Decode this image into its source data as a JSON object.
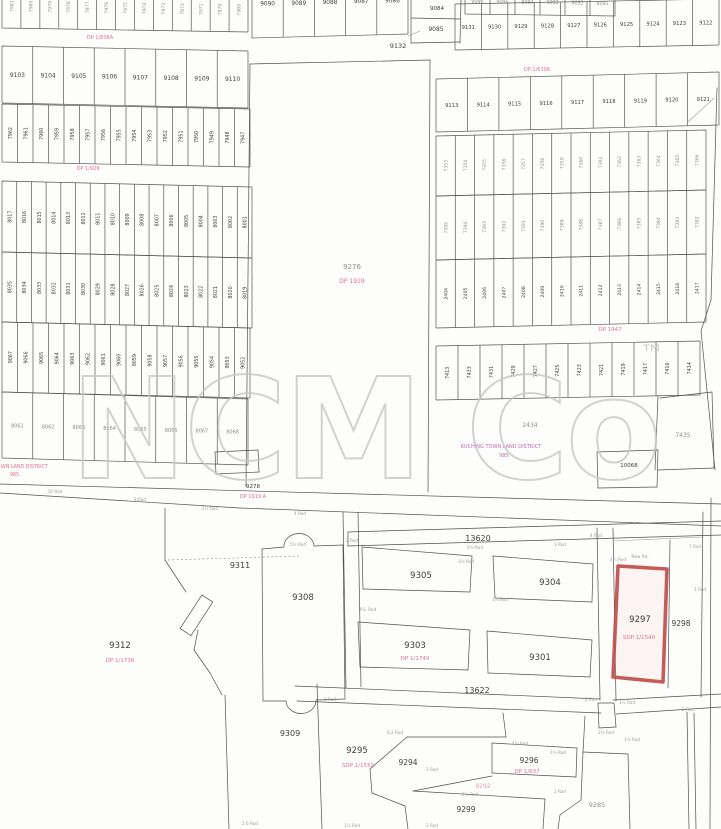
{
  "document": {
    "type": "scanned cadastral survey plan",
    "district_label": "KUCHING TOWN LAND DISTRICT",
    "district_number": "985"
  },
  "watermark": {
    "text": "NCM Co",
    "tm": "™",
    "color": "#c7c7c7"
  },
  "colors": {
    "ink": "#3d3d3d",
    "pink": "#e0718e",
    "magenta": "#bf6ab3",
    "red": "#c0504d",
    "faint": "#8d8d8d"
  },
  "red_parcel": {
    "lot": "9297",
    "plan": "SDP 1/1540",
    "points": "618,566 667,569 663,682 613,677",
    "label_x": 640,
    "label_y": 622,
    "sub_x": 639,
    "sub_y": 639,
    "color": "#c0504d"
  },
  "bands": [
    {
      "id": "top-left-cut-row",
      "x0": 2,
      "x1": 248,
      "yt": -16,
      "yb": 28,
      "sk": 4,
      "o": "v",
      "fs": 4.6,
      "faint": true,
      "labels": [
        "7981",
        "7980",
        "7979",
        "7978",
        "7977",
        "7976",
        "7975",
        "7974",
        "7973",
        "7972",
        "7971",
        "7970",
        "7969"
      ]
    },
    {
      "id": "row-9103",
      "x0": 2,
      "x1": 248,
      "yt": 46,
      "yb": 103,
      "sk": 5,
      "o": "h",
      "fs": 6,
      "labels": [
        "9103",
        "9104",
        "9105",
        "9106",
        "9107",
        "9108",
        "9109",
        "9110"
      ]
    },
    {
      "id": "row-79xx",
      "x0": 2,
      "x1": 250,
      "yt": 104,
      "yb": 162,
      "sk": 5,
      "o": "v",
      "fs": 4.8,
      "labels": [
        "7962",
        "7961",
        "7960",
        "7959",
        "7958",
        "7957",
        "7956",
        "7955",
        "7954",
        "7953",
        "7952",
        "7951",
        "7950",
        "7949",
        "7948",
        "7947"
      ]
    },
    {
      "id": "row-80xx-a",
      "x0": 2,
      "x1": 252,
      "yt": 181,
      "yb": 252,
      "sk": 6,
      "o": "v",
      "fs": 4.8,
      "labels": [
        "8017",
        "8016",
        "8015",
        "8014",
        "8013",
        "8012",
        "8011",
        "8010",
        "8009",
        "8008",
        "8007",
        "8006",
        "8005",
        "8004",
        "8003",
        "8002",
        "8001"
      ]
    },
    {
      "id": "row-80xx-b",
      "x0": 2,
      "x1": 252,
      "yt": 252,
      "yb": 322,
      "sk": 6,
      "o": "v",
      "fs": 4.8,
      "labels": [
        "8035",
        "8034",
        "8033",
        "8032",
        "8031",
        "8030",
        "8029",
        "8028",
        "8027",
        "8026",
        "8025",
        "8024",
        "8023",
        "8022",
        "8021",
        "8020",
        "8019"
      ]
    },
    {
      "id": "row-90xx",
      "x0": 2,
      "x1": 250,
      "yt": 322,
      "yb": 392,
      "sk": 6,
      "o": "v",
      "fs": 4.8,
      "labels": [
        "9067",
        "9066",
        "9065",
        "9064",
        "9063",
        "9062",
        "9061",
        "9060",
        "9059",
        "9058",
        "9057",
        "9056",
        "9055",
        "9054",
        "9053",
        "9052"
      ]
    },
    {
      "id": "row-bottom-left",
      "x0": 2,
      "x1": 248,
      "yt": 392,
      "yb": 458,
      "sk": 7,
      "o": "h",
      "fs": 5,
      "faint": true,
      "labels": [
        "8061",
        "8062",
        "8063",
        "8064",
        "8065",
        "8066",
        "8067",
        "8068"
      ]
    },
    {
      "id": "top-sliver",
      "x0": 465,
      "x1": 615,
      "yt": -12,
      "yb": 14,
      "sk": 2,
      "o": "h",
      "fs": 4.8,
      "faint": true,
      "labels": [
        "9096",
        "9095",
        "9094",
        "9093",
        "9092",
        "9091"
      ]
    },
    {
      "id": "row-9090",
      "x0": 252,
      "x1": 408,
      "yt": -30,
      "yb": 38,
      "sk": -4,
      "o": "h",
      "fs": 5.8,
      "labels": [
        "9090",
        "9089",
        "9088",
        "9087",
        "9086"
      ]
    },
    {
      "id": "row-913x",
      "x0": 455,
      "x1": 719,
      "yt": 4,
      "yb": 50,
      "sk": -5,
      "o": "h",
      "fs": 5.2,
      "labels": [
        "9131",
        "9130",
        "9129",
        "9128",
        "9127",
        "9126",
        "9125",
        "9124",
        "9123",
        "9122"
      ]
    },
    {
      "id": "row-911x",
      "x0": 436,
      "x1": 719,
      "yt": 79,
      "yb": 132,
      "sk": -7,
      "o": "h",
      "fs": 5.2,
      "labels": [
        "9113",
        "9114",
        "9115",
        "9116",
        "9117",
        "9118",
        "9119",
        "9120",
        "9121"
      ]
    },
    {
      "id": "row-73xx-a",
      "x0": 436,
      "x1": 706,
      "yt": 136,
      "yb": 196,
      "sk": -6,
      "o": "v",
      "fs": 4.6,
      "faint": true,
      "labels": [
        "7353",
        "7354",
        "7355",
        "7356",
        "7357",
        "7358",
        "7359",
        "7360",
        "7361",
        "7362",
        "7363",
        "7364",
        "7365",
        "7366"
      ]
    },
    {
      "id": "row-73xx-b",
      "x0": 436,
      "x1": 706,
      "yt": 196,
      "yb": 260,
      "sk": -6,
      "o": "v",
      "fs": 4.6,
      "faint": true,
      "labels": [
        "7395",
        "7394",
        "7393",
        "7392",
        "7391",
        "7390",
        "7389",
        "7388",
        "7387",
        "7386",
        "7385",
        "7384",
        "7383",
        "7382"
      ]
    },
    {
      "id": "row-24xx",
      "x0": 436,
      "x1": 706,
      "yt": 260,
      "yb": 328,
      "sk": -6,
      "o": "v",
      "fs": 4.6,
      "labels": [
        "2404",
        "2405",
        "2406",
        "2407",
        "2408",
        "2409",
        "2410",
        "2411",
        "2412",
        "2413",
        "2414",
        "2415",
        "2416",
        "2417"
      ]
    },
    {
      "id": "row-74xx",
      "x0": 436,
      "x1": 700,
      "yt": 346,
      "yb": 400,
      "sk": -5,
      "o": "v",
      "fs": 4.8,
      "labels": [
        "7413",
        "7433",
        "7431",
        "7429",
        "7427",
        "7425",
        "7423",
        "7421",
        "7419",
        "7417",
        "7416",
        "7414"
      ]
    }
  ],
  "labels": [
    {
      "t": "9132",
      "x": 398,
      "y": 48,
      "s": 6.5,
      "c": "ink"
    },
    {
      "t": "9084",
      "x": 437,
      "y": 10,
      "s": 5.5,
      "c": "ink"
    },
    {
      "t": "9085",
      "x": 436,
      "y": 31,
      "s": 6,
      "c": "ink"
    },
    {
      "t": "9276",
      "x": 352,
      "y": 269,
      "s": 7,
      "c": "faint"
    },
    {
      "t": "DP 1919",
      "x": 352,
      "y": 283,
      "s": 6,
      "c": "pink"
    },
    {
      "t": "9278",
      "x": 253,
      "y": 488,
      "s": 5.5,
      "c": "ink"
    },
    {
      "t": "DP 1919 A",
      "x": 253,
      "y": 498,
      "s": 5,
      "c": "pink"
    },
    {
      "t": "DP 1/838A",
      "x": 100,
      "y": 39,
      "s": 5,
      "c": "pink"
    },
    {
      "t": "DP 1/929",
      "x": 88,
      "y": 170,
      "s": 5,
      "c": "pink"
    },
    {
      "t": "DP 1/6306",
      "x": 537,
      "y": 71,
      "s": 5,
      "c": "pink"
    },
    {
      "t": "DP 1947",
      "x": 610,
      "y": 331,
      "s": 5.5,
      "c": "pink"
    },
    {
      "t": "2434",
      "x": 530,
      "y": 427,
      "s": 6,
      "c": "faint"
    },
    {
      "t": "KUCHING TOWN LAND DISTRICT",
      "x": 501,
      "y": 448,
      "s": 5,
      "c": "magenta"
    },
    {
      "t": "985",
      "x": 504,
      "y": 457,
      "s": 5,
      "c": "magenta"
    },
    {
      "t": "7435",
      "x": 683,
      "y": 437,
      "s": 6,
      "c": "faint"
    },
    {
      "t": "10068",
      "x": 629,
      "y": 467,
      "s": 5.5,
      "c": "ink"
    },
    {
      "t": "WN LAND DISTRICT",
      "x": 1,
      "y": 468,
      "s": 4.8,
      "c": "pink",
      "a": "start"
    },
    {
      "t": "985",
      "x": 10,
      "y": 476,
      "s": 4.8,
      "c": "pink",
      "a": "start"
    },
    {
      "t": "13620",
      "x": 478,
      "y": 541,
      "s": 8,
      "c": "ink"
    },
    {
      "t": "13622",
      "x": 477,
      "y": 693,
      "s": 8,
      "c": "ink"
    },
    {
      "t": "9311",
      "x": 240,
      "y": 568,
      "s": 8,
      "c": "ink"
    },
    {
      "t": "9308",
      "x": 303,
      "y": 600,
      "s": 8.5,
      "c": "ink"
    },
    {
      "t": "9312",
      "x": 120,
      "y": 648,
      "s": 8.5,
      "c": "ink"
    },
    {
      "t": "DP 1/1736",
      "x": 120,
      "y": 662,
      "s": 5.5,
      "c": "pink"
    },
    {
      "t": "9305",
      "x": 421,
      "y": 578,
      "s": 8.5,
      "c": "ink"
    },
    {
      "t": "9304",
      "x": 550,
      "y": 585,
      "s": 8.5,
      "c": "ink"
    },
    {
      "t": "9303",
      "x": 415,
      "y": 648,
      "s": 8.5,
      "c": "ink"
    },
    {
      "t": "DP 1/1749",
      "x": 415,
      "y": 660,
      "s": 5.5,
      "c": "pink"
    },
    {
      "t": "9301",
      "x": 540,
      "y": 660,
      "s": 8.5,
      "c": "ink"
    },
    {
      "t": "9298",
      "x": 681,
      "y": 626,
      "s": 7.5,
      "c": "ink"
    },
    {
      "t": "9309",
      "x": 290,
      "y": 736,
      "s": 8,
      "c": "ink"
    },
    {
      "t": "9295",
      "x": 357,
      "y": 753,
      "s": 8.5,
      "c": "ink"
    },
    {
      "t": "SDP 1/1552",
      "x": 358,
      "y": 767,
      "s": 5.5,
      "c": "pink"
    },
    {
      "t": "9294",
      "x": 408,
      "y": 765,
      "s": 7.5,
      "c": "ink"
    },
    {
      "t": "9296",
      "x": 529,
      "y": 763,
      "s": 7.5,
      "c": "ink"
    },
    {
      "t": "DP 1/637",
      "x": 527,
      "y": 773,
      "s": 5.5,
      "c": "pink"
    },
    {
      "t": "9299",
      "x": 466,
      "y": 812,
      "s": 7.5,
      "c": "ink"
    },
    {
      "t": "9285",
      "x": 597,
      "y": 807,
      "s": 6.5,
      "c": "faint"
    },
    {
      "t": "9292",
      "x": 483,
      "y": 788,
      "s": 6,
      "c": "pinkfaint"
    }
  ],
  "micro_labels": [
    [
      210,
      510,
      "5½ Rod"
    ],
    [
      140,
      501,
      "8 Rod"
    ],
    [
      55,
      493,
      "10 Rod"
    ],
    [
      300,
      515,
      "4 Rod"
    ],
    [
      352,
      542,
      "2 Rod"
    ],
    [
      475,
      549,
      "5¼ Rod"
    ],
    [
      560,
      546,
      "3 Rod"
    ],
    [
      640,
      558,
      "New Rd."
    ],
    [
      466,
      563,
      "3½ Rod"
    ],
    [
      500,
      601,
      "1¾ Rod"
    ],
    [
      368,
      611,
      "P.S. Rod"
    ],
    [
      596,
      537,
      "4 Rod"
    ],
    [
      695,
      548,
      "7 Rod"
    ],
    [
      700,
      591,
      "1 Rod"
    ],
    [
      591,
      701,
      "2 Rod"
    ],
    [
      627,
      704,
      "1½ Rod"
    ],
    [
      606,
      734,
      "2½ Rod"
    ],
    [
      632,
      741,
      "1¾ Rod"
    ],
    [
      330,
      701,
      "3 Rod"
    ],
    [
      395,
      734,
      "6.2 Rod"
    ],
    [
      520,
      745,
      "4¾ Rod"
    ],
    [
      558,
      754,
      "1¾ Rod"
    ],
    [
      432,
      771,
      "3 Rod"
    ],
    [
      470,
      796,
      "2½ Rod"
    ],
    [
      560,
      793,
      "2 Rod"
    ],
    [
      250,
      825,
      "2.6 Rod"
    ],
    [
      352,
      827,
      "1½ Rod"
    ],
    [
      432,
      827,
      "2 Rod"
    ],
    [
      298,
      546,
      "5½ Rod"
    ],
    [
      618,
      561,
      "4¾ Rod"
    ],
    [
      688,
      711,
      "2 Rod"
    ]
  ],
  "lines": [
    [
      0,
      484,
      721,
      504
    ],
    [
      0,
      493,
      240,
      508
    ],
    [
      240,
      508,
      721,
      526
    ],
    [
      215,
      452,
      258,
      450
    ],
    [
      215,
      452,
      216,
      474
    ],
    [
      258,
      450,
      259,
      472
    ],
    [
      216,
      474,
      259,
      472
    ],
    [
      343,
      512,
      346,
      688
    ],
    [
      358,
      512,
      361,
      687
    ],
    [
      348,
      532,
      721,
      521
    ],
    [
      348,
      546,
      721,
      535
    ],
    [
      348,
      532,
      348,
      546
    ],
    [
      362,
      547,
      472,
      556
    ],
    [
      472,
      556,
      470,
      592
    ],
    [
      470,
      592,
      363,
      589
    ],
    [
      363,
      589,
      362,
      547
    ],
    [
      493,
      556,
      593,
      564
    ],
    [
      593,
      564,
      592,
      602
    ],
    [
      592,
      602,
      495,
      598
    ],
    [
      495,
      598,
      493,
      556
    ],
    [
      358,
      622,
      470,
      630
    ],
    [
      470,
      630,
      468,
      670
    ],
    [
      468,
      670,
      360,
      667
    ],
    [
      360,
      667,
      358,
      622
    ],
    [
      487,
      631,
      592,
      640
    ],
    [
      592,
      640,
      590,
      677
    ],
    [
      590,
      677,
      488,
      673
    ],
    [
      488,
      673,
      487,
      631
    ],
    [
      597,
      528,
      600,
      700
    ],
    [
      613,
      528,
      616,
      701
    ],
    [
      295,
      686,
      600,
      699
    ],
    [
      613,
      700,
      721,
      694
    ],
    [
      297,
      701,
      601,
      713
    ],
    [
      616,
      714,
      721,
      707
    ],
    [
      598,
      703,
      614,
      703
    ],
    [
      598,
      703,
      599,
      728
    ],
    [
      614,
      703,
      616,
      727
    ],
    [
      599,
      728,
      616,
      727
    ],
    [
      225,
      695,
      229,
      829
    ],
    [
      317,
      684,
      322,
      829
    ],
    [
      165,
      508,
      165,
      560
    ],
    [
      165,
      560,
      186,
      592
    ],
    [
      198,
      630,
      194,
      650
    ],
    [
      194,
      650,
      210,
      673
    ],
    [
      210,
      673,
      222,
      695
    ],
    [
      168,
      560,
      300,
      556,
      2
    ],
    [
      670,
      540,
      668,
      688
    ],
    [
      613,
      541,
      703,
      537,
      1
    ],
    [
      703,
      512,
      701,
      697
    ],
    [
      711,
      498,
      710,
      829
    ],
    [
      687,
      712,
      689,
      829
    ],
    [
      694,
      713,
      696,
      829
    ],
    [
      658,
      396,
      655,
      470
    ],
    [
      660,
      398,
      712,
      392
    ],
    [
      712,
      392,
      714,
      468
    ],
    [
      714,
      468,
      658,
      470
    ],
    [
      597,
      452,
      658,
      450
    ],
    [
      597,
      452,
      598,
      488
    ],
    [
      658,
      450,
      657,
      487
    ],
    [
      598,
      488,
      657,
      487
    ],
    [
      717,
      88,
      711,
      300
    ],
    [
      711,
      300,
      701,
      331
    ],
    [
      701,
      331,
      715,
      470
    ],
    [
      688,
      122,
      714,
      98,
      1
    ],
    [
      503,
      713,
      506,
      737
    ],
    [
      506,
      737,
      407,
      737
    ],
    [
      407,
      737,
      370,
      769
    ],
    [
      370,
      769,
      372,
      793
    ],
    [
      372,
      793,
      405,
      806
    ],
    [
      405,
      806,
      408,
      829
    ],
    [
      492,
      743,
      577,
      748
    ],
    [
      577,
      748,
      576,
      777
    ],
    [
      576,
      777,
      492,
      773
    ],
    [
      492,
      773,
      492,
      743
    ],
    [
      492,
      776,
      413,
      791
    ],
    [
      413,
      791,
      545,
      799
    ],
    [
      545,
      799,
      543,
      829
    ],
    [
      583,
      752,
      628,
      754
    ],
    [
      628,
      754,
      630,
      829
    ],
    [
      583,
      752,
      581,
      800
    ],
    [
      581,
      800,
      560,
      815
    ],
    [
      560,
      815,
      558,
      829
    ],
    [
      585,
      716,
      583,
      752
    ],
    [
      411,
      0,
      411,
      43
    ],
    [
      461,
      0,
      460,
      43
    ],
    [
      411,
      18,
      460,
      19
    ],
    [
      411,
      43,
      460,
      42
    ],
    [
      250,
      64,
      430,
      60
    ],
    [
      250,
      64,
      246,
      487
    ],
    [
      430,
      60,
      428,
      492
    ],
    [
      408,
      36,
      420,
      31,
      1
    ]
  ],
  "paths": [
    {
      "d": "M262,549 L284,547 A15 13 0 0 1 314 546 L343,545 L345,699 L316,700 A15 13 0 0 1 286 701 L263,701 Z",
      "name": "parcel-9308-outline"
    }
  ],
  "rects": [
    {
      "x": 190,
      "y": 595,
      "w": 13,
      "h": 40,
      "rot": 33,
      "cx": 196,
      "cy": 615,
      "name": "small-rotated-reserve"
    }
  ]
}
